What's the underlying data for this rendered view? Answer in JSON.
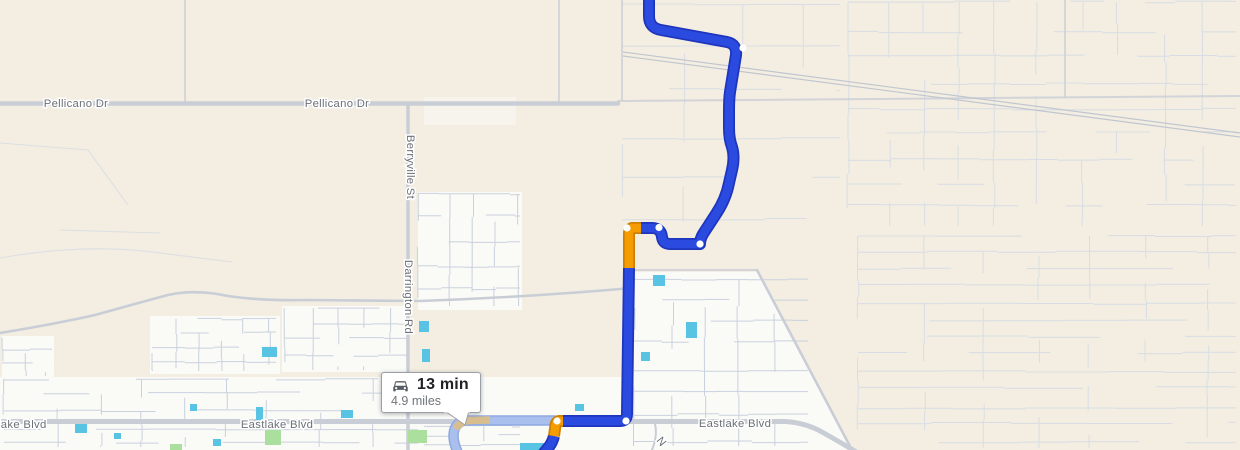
{
  "view": {
    "type": "map-route-view"
  },
  "tooltip": {
    "icon": "car-icon",
    "duration": "13 min",
    "distance": "4.9 miles"
  },
  "street_labels": {
    "pellicano_west": "Pellicano Dr",
    "pellicano_east": "Pellicano Dr",
    "berryville": "Berryville St",
    "darrington": "Darrington Rd",
    "eastlake_clipped_west": "lake Blvd",
    "eastlake_center": "Eastlake Blvd",
    "eastlake_east": "Eastlake Blvd",
    "minor_road_n": "N"
  },
  "theme": {
    "land": "#f3eee1",
    "developed": "#fafaf7",
    "street-line": "#d2d9e5",
    "street-line-strong": "#c9d1de",
    "road": "#c9cdd6",
    "road-label": "#6b7077",
    "rail": "#c0c6d0",
    "water": "#58c3e2",
    "park": "#abdf9d",
    "route-blue": "#2b4adf",
    "route-blue-border": "#1e35bd",
    "route-orange": "#f59d00",
    "route-orange-border": "#cf8000",
    "route-alt": "#a9bfee",
    "route-alt-border": "#8ea8e0",
    "route-alt-slow": "#d8bd8f",
    "dot": "#ffffff",
    "tooltip-border": "#9aa0a6",
    "tooltip-text": "#202124",
    "tooltip-subtext": "#70757a"
  },
  "route": {
    "paths": {
      "blue_top": "M649,-8 L649,16 Q649,28 661,30 L727,42 Q737,44 736,55 L730,92 Q729,99 729,111 L729,128 Q729,139 732,147 Q735,157 732,170 L729,183 Q726,199 716,214 L703,234 Q700,239 700,244 L670,244 Q663,244 662,237 Q661,228 652,228 L641,228",
      "orange_upper": "M641,228 L632,228 Q629,229 629,234 L629,268",
      "blue_mid": "M629,268 L627,414 Q627,421 620,421 L563,421",
      "orange_lower": "M563,421 L559,421 Q556,422 555.5,425 L554,436",
      "blue_tail": "M554,436 Q552,444 547,449 L543,454",
      "alternate": "M458,453 Q452,440 454,431 Q456,423 464,420.5 L556,420.5",
      "alternate_slow": "M456,429 Q459,422 468,420.5 L490,420"
    },
    "waypoints": [
      [
        743,
        48
      ],
      [
        659,
        227.5
      ],
      [
        700,
        244
      ],
      [
        627,
        228
      ],
      [
        626,
        421
      ],
      [
        557,
        421
      ]
    ]
  },
  "water_features": [
    [
      653,
      275,
      12,
      11
    ],
    [
      686,
      322,
      11,
      16
    ],
    [
      641,
      352,
      9,
      9
    ],
    [
      419,
      321,
      10,
      11
    ],
    [
      422,
      349,
      8,
      13
    ],
    [
      262,
      347,
      15,
      10
    ],
    [
      75,
      424,
      12,
      9
    ],
    [
      190,
      404,
      7,
      7
    ],
    [
      114,
      433,
      7,
      6
    ],
    [
      213,
      439,
      8,
      7
    ],
    [
      520,
      443,
      26,
      7
    ],
    [
      341,
      410,
      12,
      8
    ],
    [
      575,
      404,
      9,
      7
    ],
    [
      256,
      407,
      7,
      13
    ]
  ],
  "parks": [
    [
      265,
      430,
      16,
      15
    ],
    [
      408,
      430,
      19,
      13
    ],
    [
      170,
      444,
      12,
      6
    ]
  ]
}
